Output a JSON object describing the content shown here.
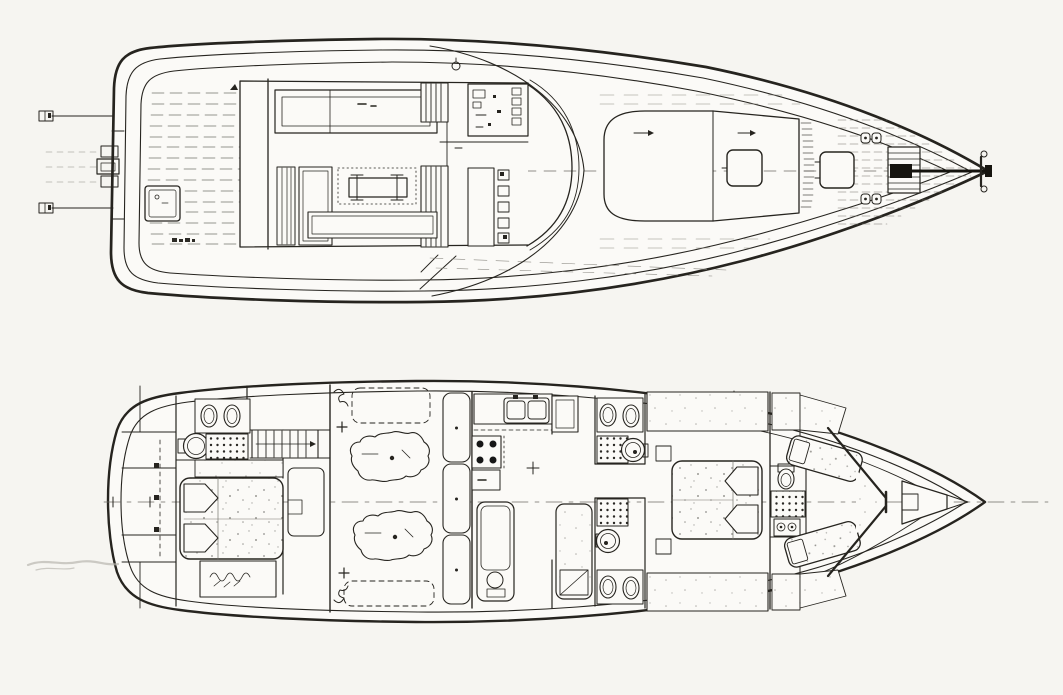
{
  "figure": {
    "title": "Motor yacht general arrangement drawing",
    "drawing_style": "scanned black-ink plan drawing on white paper",
    "paper_color": "#f6f5f1",
    "ink_color": "#26241f",
    "orientation": "bow facing right, stern at left",
    "views": [
      {
        "name": "Main deck plan",
        "position": "top",
        "features": [
          "transom boarding fittings",
          "stern centerline fitting cluster",
          "aft deck with planked sole",
          "aft deck locker hatch",
          "cockpit bulkhead",
          "deck saloon L-settee",
          "dinette table with pedestal legs",
          "saloon benches",
          "companionway steps (two sets)",
          "helm console with instruments",
          "roof compass",
          "curved wrap-around windshield",
          "trunk cabin",
          "forward cabin-top hatch",
          "foredeck hatch",
          "mooring cleats (two pairs)",
          "anchor windlass",
          "anchor chain run",
          "stem head anchor fitting",
          "centerline"
        ]
      },
      {
        "name": "Lower deck accommodation plan",
        "position": "bottom",
        "features": [
          "transom stowage lockers",
          "hanging wardrobe with shelf marks",
          "owner's aft cabin double berth",
          "dresser seat",
          "aft en-suite head: twin basins, WC, shower",
          "companionway stairs",
          "bedside cabinet",
          "engine room: twin engines, fore and aft tanks, mount crosses",
          "locker column on forward engine-room bulkhead",
          "galley: twin-bowl sink, four-burner stove, worktop, refrigerator",
          "lower head with shower pan and WC",
          "single berth cabin",
          "midship heads port and starboard: basins, WC, shower",
          "midship double berth cabin",
          "wardrobe banks",
          "forward head on centerline: WC, shower, basin",
          "crew forepeak V-berths",
          "chain locker",
          "centerline with station ticks"
        ]
      }
    ]
  }
}
